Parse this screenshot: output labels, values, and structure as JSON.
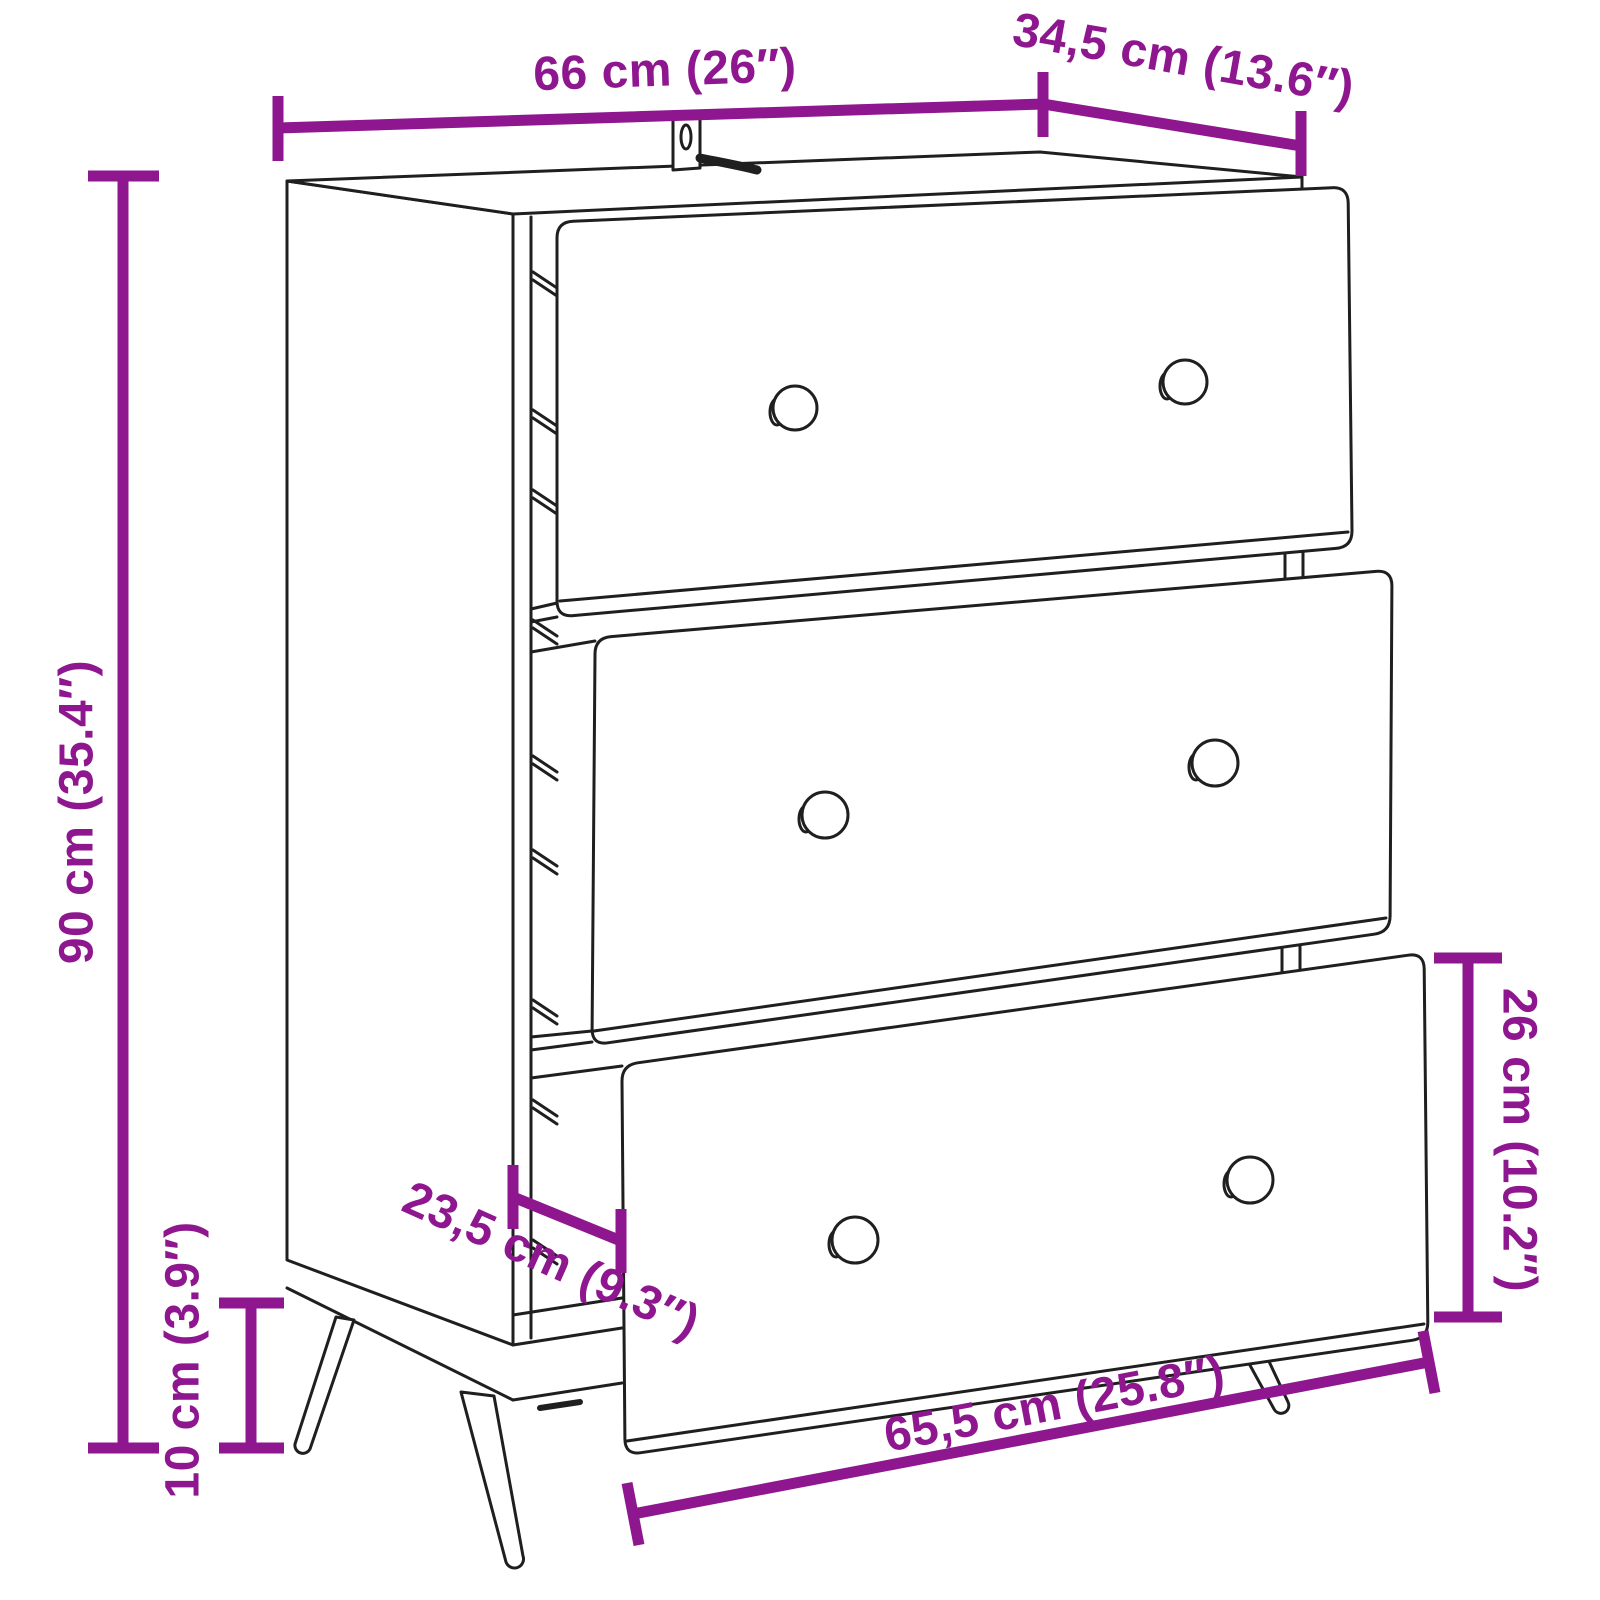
{
  "figure": {
    "kind": "product-dimension-diagram",
    "subject": "sideboard with 3 open drawers, tapered legs and wall-mount bracket",
    "background": "#ffffff"
  },
  "colors": {
    "dimension_annotation": "#8e168e",
    "line_art": "#1f1f1f"
  },
  "dimensions": {
    "width": {
      "label": "66 cm (26″)"
    },
    "depth": {
      "label": "34,5 cm (13.6″)"
    },
    "height": {
      "label": "90 cm (35.4″)"
    },
    "leg_height": {
      "label": "10 cm (3.9″)"
    },
    "drawer_depth": {
      "label": "23,5 cm (9.3″)"
    },
    "drawer_height": {
      "label": "26 cm (10.2″)"
    },
    "drawer_width": {
      "label": "65,5 cm (25.8″)"
    }
  }
}
